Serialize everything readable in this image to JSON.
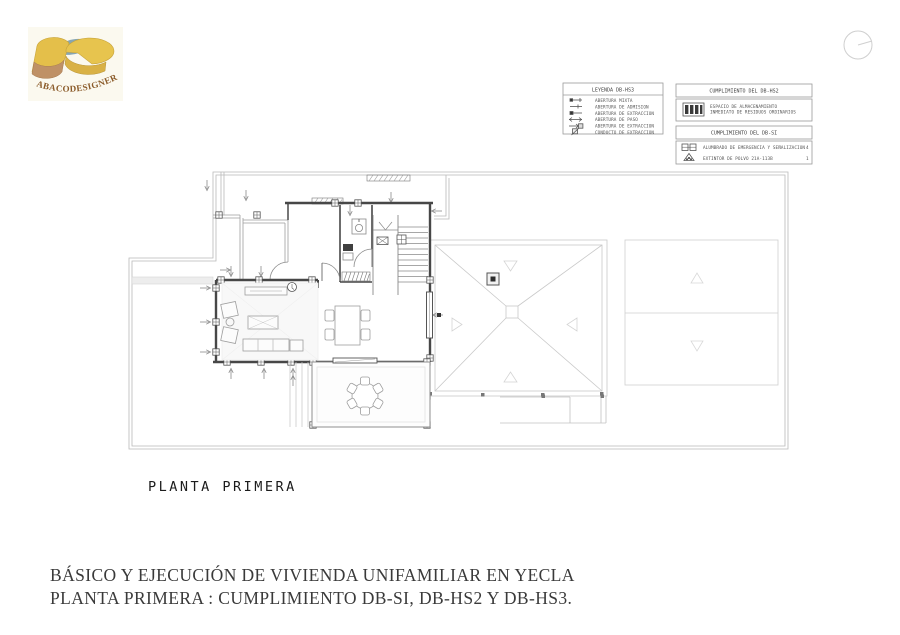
{
  "page": {
    "logo_text": "ABACODESIGNER",
    "plan_label": "PLANTA PRIMERA",
    "title_line1": "BÁSICO Y EJECUCIÓN DE VIVIENDA UNIFAMILIAR EN YECLA",
    "title_line2": "PLANTA PRIMERA : CUMPLIMIENTO DB-SI, DB-HS2 Y DB-HS3."
  },
  "legend_hs3": {
    "title": "LEYENDA DB-HS3",
    "items": [
      {
        "symbol": "abertura-mixta-symbol",
        "label": "ABERTURA MIXTA"
      },
      {
        "symbol": "abertura-admision-symbol",
        "label": "ABERTURA DE ADMISION"
      },
      {
        "symbol": "abertura-extraccion-symbol",
        "label": "ABERTURA DE EXTRACCION"
      },
      {
        "symbol": "abertura-paso-symbol",
        "label": "ABERTURA DE PASO"
      },
      {
        "symbol": "abertura-extraccion-muro-symbol",
        "label": "ABERTURA DE EXTRACCION"
      },
      {
        "symbol": "conducto-extraccion-symbol",
        "label": "CONDUCTO DE EXTRACCION"
      }
    ]
  },
  "legend_hs2": {
    "title": "CUMPLIMIENTO DEL DB-HS2",
    "item": {
      "symbol": "almacen-residuos-symbol",
      "label_line1": "ESPACIO DE ALMACENAMIENTO",
      "label_line2": "INMEDIATO DE RESIDUOS ORDINARIOS"
    }
  },
  "legend_si": {
    "title": "CUMPLIMIENTO DEL DB-SI",
    "items": [
      {
        "symbol": "alumbrado-emergencia-symbol",
        "label": "ALUMBRADO DE EMERGENCIA Y SEÑALIZACION",
        "count": "4"
      },
      {
        "symbol": "extintor-symbol",
        "label": "EXTINTOR DE POLVO 21A-113B",
        "count": "1"
      }
    ]
  },
  "colors": {
    "wall": "#474747",
    "thin_line": "#b9b9b9",
    "roof_line": "#cccccc",
    "symbol_dark": "#333333",
    "logo_gold": "#e4bf4a",
    "logo_tan": "#bf9166",
    "logo_slate": "#86a6b4",
    "logo_text": "#8a5a28",
    "text_dark": "#3a3a3a"
  }
}
